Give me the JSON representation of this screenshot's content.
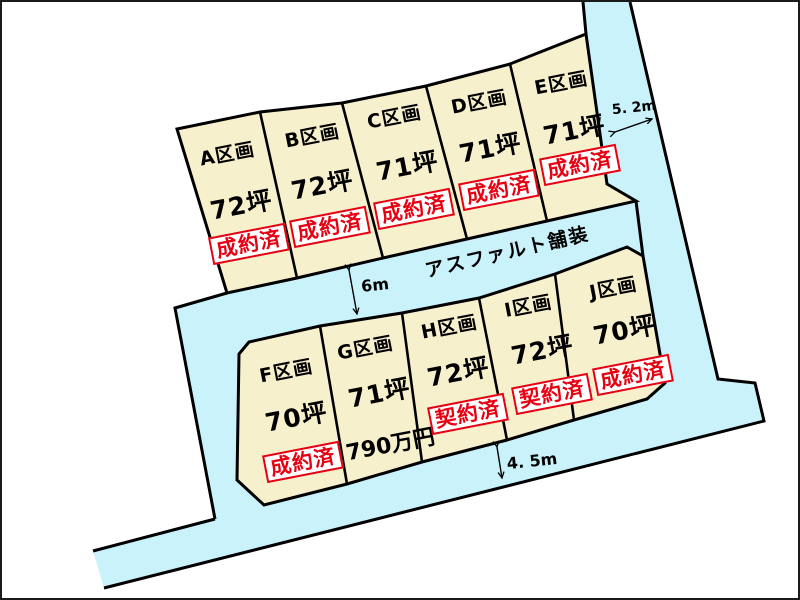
{
  "roads": {
    "surface_label": "アスファルト舗装",
    "right_road_width": "5. 2m",
    "middle_road_width": "6m",
    "bottom_road_width": "4. 5m"
  },
  "colors": {
    "road_fill": "#c9f2fb",
    "plot_fill": "#f7f0cc",
    "outline": "#000000",
    "status_red": "#e60012",
    "status_bg": "#ffffff",
    "background": "#ffffff"
  },
  "plots": [
    {
      "id": "A",
      "label": "A区画",
      "area": "72坪",
      "status": "成約済"
    },
    {
      "id": "B",
      "label": "B区画",
      "area": "72坪",
      "status": "成約済"
    },
    {
      "id": "C",
      "label": "C区画",
      "area": "71坪",
      "status": "成約済"
    },
    {
      "id": "D",
      "label": "D区画",
      "area": "71坪",
      "status": "成約済"
    },
    {
      "id": "E",
      "label": "E区画",
      "area": "71坪",
      "status": "成約済"
    },
    {
      "id": "F",
      "label": "F区画",
      "area": "70坪",
      "status": "成約済"
    },
    {
      "id": "G",
      "label": "G区画",
      "area": "71坪",
      "price": "790万円"
    },
    {
      "id": "H",
      "label": "H区画",
      "area": "72坪",
      "status": "契約済"
    },
    {
      "id": "I",
      "label": "I区画",
      "area": "72坪",
      "status": "契約済"
    },
    {
      "id": "J",
      "label": "J区画",
      "area": "70坪",
      "status": "成約済"
    }
  ]
}
